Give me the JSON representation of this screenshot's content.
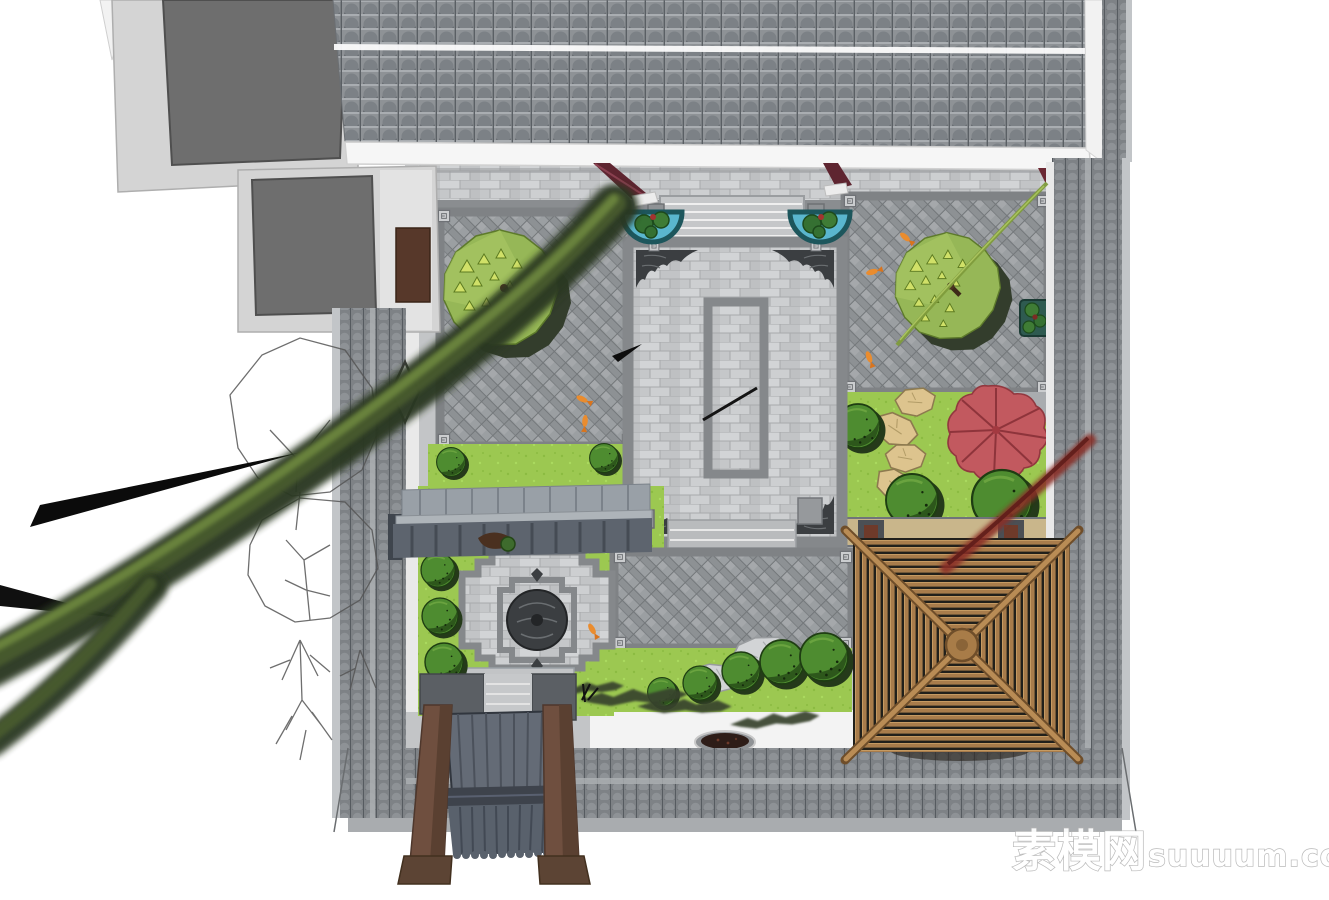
{
  "watermark": {
    "text": "素模网suuuum.com",
    "cn": "素模网",
    "en": "suuuum.com"
  },
  "palette": {
    "background": "#ffffff",
    "roof_tile_gray": "#8e9296",
    "roof_tile_dark": "#3f444a",
    "flat_roof_gray": "#6e6e6e",
    "building_wall_light": "#d6d6d6",
    "perimeter_wall_tile": "#7e8286",
    "paving_light_stone": "#c9cbcd",
    "paving_border_gray": "#85888b",
    "herringbone_gray": "#94989b",
    "lawn_green": "#9cc851",
    "tree_canopy_green": "#96b757",
    "canopy_triangle_green": "#d0e068",
    "shrub_green": "#4e8c30",
    "shrub_shadow_green": "#2d571b",
    "red_maple": "#c2595f",
    "pavilion_wood_brown": "#a87c4b",
    "pavilion_slat_gap": "#21201b",
    "gate_pillar_brown": "#6f4f3f",
    "gate_roof_slate": "#59616c",
    "basin_teal": "#5ab6ce",
    "basin_rim_teal": "#1d565c",
    "beam_maroon": "#5e2530",
    "stepping_stone_tan": "#ddc48e",
    "fir_dark_green": "#2c3821",
    "koi_orange": "#ea8c2e",
    "watermark_outline": "#b4b4b4"
  },
  "scene": {
    "objects": [
      "modern-flat-roof-building",
      "main-tiled-roof",
      "roof-ridge-white-band",
      "roof-eave",
      "perimeter-wall-left",
      "perimeter-wall-right",
      "perimeter-wall-bottom",
      "top-walkway",
      "entrance-steps",
      "maroon-struts",
      "lotus-water-basins",
      "central-paved-court",
      "central-planter-ring",
      "corner-ornaments",
      "left-herringbone-court",
      "right-herringbone-court",
      "round-canopy-trees",
      "right-garden-lawn",
      "stepping-stones",
      "red-maple-tree",
      "boxwood-shrubs",
      "covered-corridor-roof",
      "lower-left-court",
      "stone-medallion",
      "wooden-pavilion",
      "entrance-gate",
      "garden-rocks",
      "pine-branches",
      "bronze-basin",
      "fir-trees",
      "sketch-outline-trees",
      "koi-fish",
      "site-watermark"
    ]
  }
}
